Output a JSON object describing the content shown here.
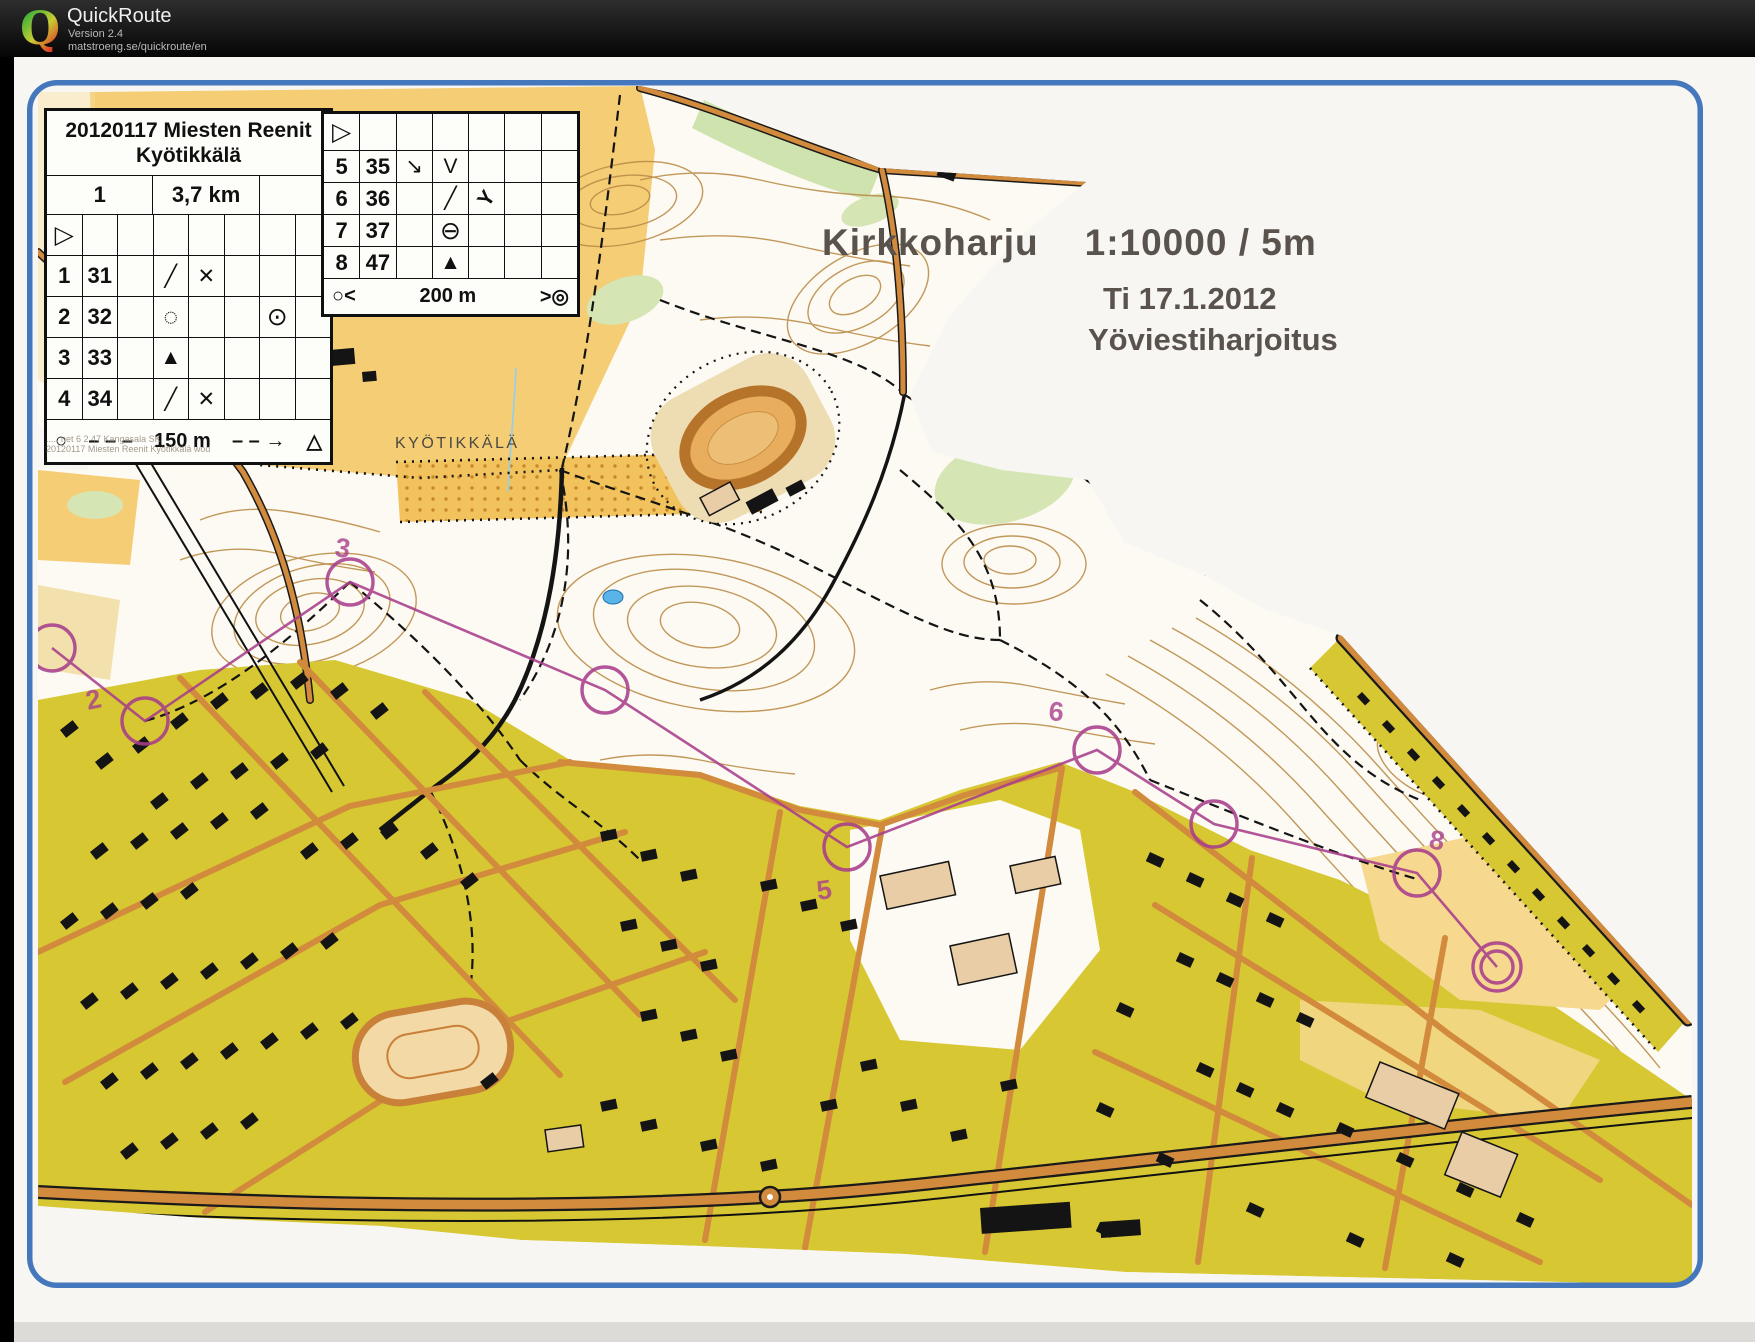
{
  "header": {
    "logo_letter": "Q",
    "app_name": "QuickRoute",
    "version": "Version 2.4",
    "url": "matstroeng.se/quickroute/en"
  },
  "map_titles": {
    "name": "Kirkkoharju",
    "scale": "1:10000 / 5m",
    "date": "Ti 17.1.2012",
    "event": "Yöviestiharjoitus",
    "place_label": "KYÖTIKKÄLÄ",
    "fine_print_1": "..... net 6 2 47 Kangasala SK",
    "fine_print_2": "20120117 Miesten Reenit Kyötikkälä wod"
  },
  "card1": {
    "title_line1": "20120117 Miesten Reenit",
    "title_line2": "Kyötikkälä",
    "course_number": "1",
    "course_length": "3,7 km",
    "start_symbol": "▷",
    "rows": [
      {
        "n": "1",
        "code": "31",
        "c": "",
        "d": "╱",
        "e": "✕",
        "g": ""
      },
      {
        "n": "2",
        "code": "32",
        "c": "",
        "d": "◌",
        "e": "",
        "g": "⊙"
      },
      {
        "n": "3",
        "code": "33",
        "c": "",
        "d": "▲",
        "e": "",
        "g": ""
      },
      {
        "n": "4",
        "code": "34",
        "c": "",
        "d": "╱",
        "e": "✕",
        "g": ""
      }
    ],
    "footer": {
      "circle": "○",
      "dash1": "– – –",
      "label": "150 m",
      "dash2": "– – →",
      "triangle": "△"
    }
  },
  "card2": {
    "start_symbol": "▷",
    "rows": [
      {
        "n": "5",
        "code": "35",
        "c": "↘",
        "d": "V",
        "e": ""
      },
      {
        "n": "6",
        "code": "36",
        "c": "",
        "d": "╱",
        "e": "Y"
      },
      {
        "n": "7",
        "code": "37",
        "c": "",
        "d": "⊖",
        "e": ""
      },
      {
        "n": "8",
        "code": "47",
        "c": "",
        "d": "▲",
        "e": ""
      }
    ],
    "footer": {
      "left": "○<",
      "label": "200 m",
      "right": ">◎"
    }
  },
  "course": {
    "control_labels": [
      "2",
      "3",
      "5",
      "6",
      "8"
    ],
    "course_color": "#a83e8c"
  },
  "colors": {
    "frame_blue": "#4577bd",
    "field_yellow": "#f5cd74",
    "urban_olive": "#d7c733",
    "road_orange": "#d28a3c",
    "contour_brown": "#bb8c49"
  }
}
